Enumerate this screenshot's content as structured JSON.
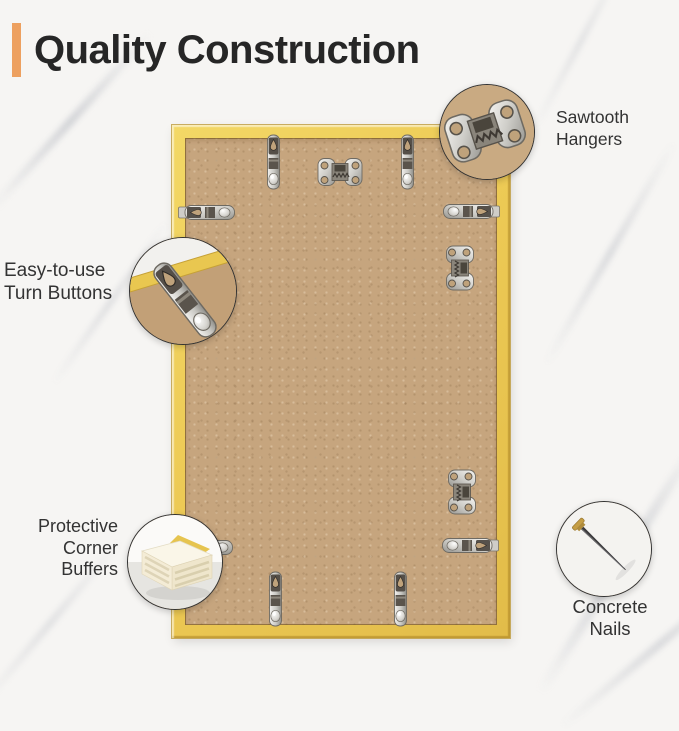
{
  "title": {
    "text": "Quality Construction"
  },
  "colors": {
    "accent_orange": "#EDA05F",
    "frame_gold": "#EDCA55",
    "backing_tan": "#C6A57E",
    "title_text": "#262626",
    "label_text": "#333333",
    "marble_background": "#F6F5F3",
    "metal_silver": "#D8D7D3"
  },
  "callouts": {
    "sawtooth_hangers": {
      "label": "Sawtooth\nHangers",
      "icon": "sawtooth-hanger-icon"
    },
    "turn_buttons": {
      "label": "Easy-to-use\nTurn Buttons",
      "icon": "turn-button-icon"
    },
    "corner_buffers": {
      "label": "Protective\nCorner\nBuffers",
      "icon": "corner-buffer-icon"
    },
    "concrete_nails": {
      "label": "Concrete\nNails",
      "icon": "concrete-nail-icon"
    }
  }
}
